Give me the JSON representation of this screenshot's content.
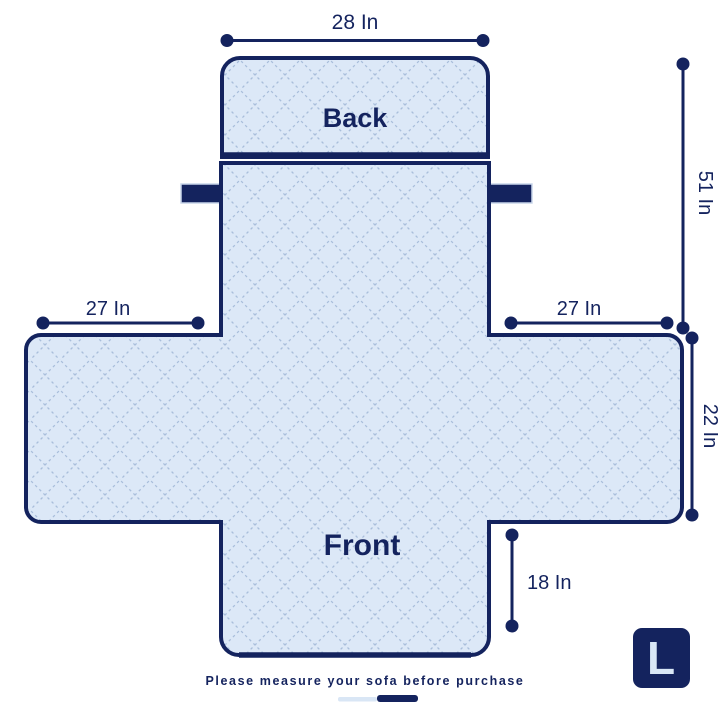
{
  "diagram_title": "Sofa cover size diagram",
  "labels": {
    "back": "Back",
    "front": "Front"
  },
  "measurements": {
    "top_width": "28 In",
    "side_height": "51 In",
    "left_arm_width": "27 In",
    "right_arm_width": "27 In",
    "arm_depth": "22 In",
    "front_skirt_height": "18 In"
  },
  "badge": {
    "size": "L"
  },
  "footer": {
    "note": "Please measure your sofa before purchase"
  },
  "colors": {
    "navy": "#14235e",
    "fabric_fill": "#dce8f7",
    "quilt_line": "#a9bedb",
    "badge_text": "#d9e7f6",
    "indicator_light": "#d9e6f5",
    "background": "#ffffff"
  }
}
